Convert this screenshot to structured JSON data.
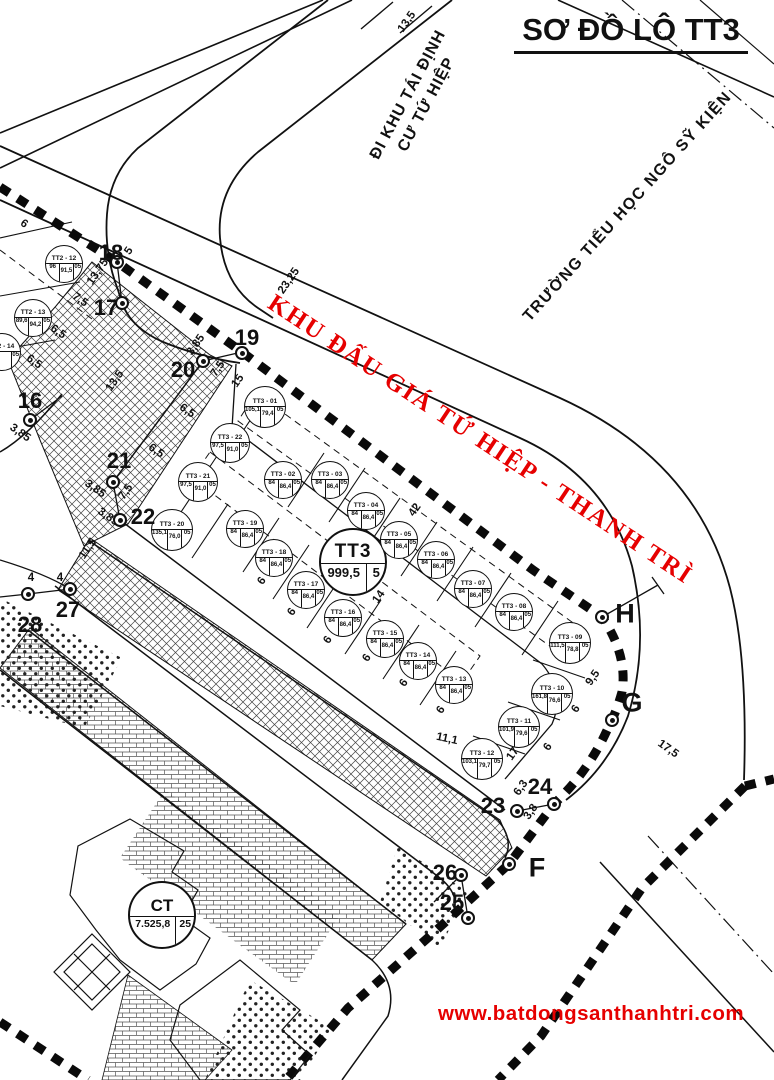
{
  "title": "SƠ ĐỒ LÔ TT3",
  "website": "www.batdongsanthanhtri.com",
  "banner": "KHU ĐẤU GIÁ TỨ HIỆP - THANH TRÌ",
  "streets": {
    "tai_dinh_line1": "ĐI KHU TÁI ĐỊNH",
    "tai_dinh_line2": "CƯ TỨ HIỆP",
    "school": "TRƯỜNG TIỂU HỌC NGÔ SỸ KIỆN"
  },
  "colors": {
    "accent_red": "#e60000",
    "ink": "#111111"
  },
  "big": {
    "tt3": {
      "code": "TT3",
      "v1": "999,5",
      "v2": "5"
    },
    "ct": {
      "code": "CT",
      "v1": "7.525,8",
      "v2": "25"
    }
  },
  "plots": [
    {
      "code": "TT2 - 12",
      "x": 64,
      "y": 264,
      "v": [
        "96",
        "91,5",
        "05"
      ]
    },
    {
      "code": "TT2 - 13",
      "x": 33,
      "y": 318,
      "v": [
        "89,6",
        "94,2",
        "05"
      ]
    },
    {
      "code": "TT2 - 14",
      "x": 2,
      "y": 352,
      "v": [
        "2",
        "",
        "05"
      ]
    },
    {
      "code": "TT3 - 01",
      "x": 265,
      "y": 407,
      "r": 21,
      "v": [
        "105,1",
        "79,4",
        "05"
      ]
    },
    {
      "code": "TT3 - 02",
      "x": 283,
      "y": 480,
      "v": [
        "84",
        "86,4",
        "05"
      ]
    },
    {
      "code": "TT3 - 03",
      "x": 330,
      "y": 480,
      "v": [
        "84",
        "86,4",
        "05"
      ]
    },
    {
      "code": "TT3 - 04",
      "x": 366,
      "y": 511,
      "v": [
        "84",
        "86,4",
        "05"
      ]
    },
    {
      "code": "TT3 - 05",
      "x": 399,
      "y": 540,
      "v": [
        "84",
        "86,4",
        "05"
      ]
    },
    {
      "code": "TT3 - 06",
      "x": 436,
      "y": 560,
      "v": [
        "84",
        "86,4",
        "05"
      ]
    },
    {
      "code": "TT3 - 07",
      "x": 473,
      "y": 589,
      "v": [
        "84",
        "86,4",
        "05"
      ]
    },
    {
      "code": "TT3 - 08",
      "x": 514,
      "y": 612,
      "v": [
        "84",
        "86,4",
        "05"
      ]
    },
    {
      "code": "TT3 - 09",
      "x": 570,
      "y": 643,
      "r": 21,
      "v": [
        "111,5",
        "78,8",
        "05"
      ]
    },
    {
      "code": "TT3 - 10",
      "x": 552,
      "y": 694,
      "r": 21,
      "v": [
        "161,8",
        "76,6",
        "05"
      ]
    },
    {
      "code": "TT3 - 11",
      "x": 519,
      "y": 727,
      "r": 21,
      "v": [
        "101,9",
        "79,6",
        "05"
      ]
    },
    {
      "code": "TT3 - 12",
      "x": 482,
      "y": 759,
      "r": 21,
      "v": [
        "103,1",
        "79,7",
        "05"
      ]
    },
    {
      "code": "TT3 - 13",
      "x": 454,
      "y": 685,
      "v": [
        "84",
        "86,4",
        "05"
      ]
    },
    {
      "code": "TT3 - 14",
      "x": 418,
      "y": 661,
      "v": [
        "84",
        "86,4",
        "05"
      ]
    },
    {
      "code": "TT3 - 15",
      "x": 385,
      "y": 639,
      "v": [
        "84",
        "86,4",
        "05"
      ]
    },
    {
      "code": "TT3 - 16",
      "x": 343,
      "y": 618,
      "v": [
        "84",
        "86,4",
        "05"
      ]
    },
    {
      "code": "TT3 - 17",
      "x": 306,
      "y": 590,
      "v": [
        "84",
        "86,4",
        "05"
      ]
    },
    {
      "code": "TT3 - 18",
      "x": 274,
      "y": 558,
      "v": [
        "84",
        "86,4",
        "05"
      ]
    },
    {
      "code": "TT3 - 19",
      "x": 245,
      "y": 529,
      "v": [
        "84",
        "86,4",
        "05"
      ]
    },
    {
      "code": "TT3 - 20",
      "x": 172,
      "y": 530,
      "r": 21,
      "v": [
        "135,1",
        "76,0",
        "05"
      ]
    },
    {
      "code": "TT3 - 21",
      "x": 198,
      "y": 482,
      "r": 20,
      "v": [
        "97,5",
        "91,0",
        "05"
      ]
    },
    {
      "code": "TT3 - 22",
      "x": 230,
      "y": 443,
      "r": 20,
      "v": [
        "97,5",
        "91,0",
        "05"
      ]
    }
  ],
  "nodes": [
    {
      "label": "16",
      "mx": 30,
      "my": 420,
      "lx": 30,
      "ly": 401
    },
    {
      "label": "17",
      "mx": 122,
      "my": 303,
      "lx": 106,
      "ly": 308
    },
    {
      "label": "18",
      "mx": 117,
      "my": 262,
      "lx": 111,
      "ly": 253
    },
    {
      "label": "19",
      "mx": 242,
      "my": 353,
      "lx": 247,
      "ly": 338
    },
    {
      "label": "20",
      "mx": 203,
      "my": 361,
      "lx": 183,
      "ly": 370
    },
    {
      "label": "21",
      "mx": 113,
      "my": 482,
      "lx": 119,
      "ly": 461
    },
    {
      "label": "22",
      "mx": 120,
      "my": 520,
      "lx": 143,
      "ly": 517
    },
    {
      "label": "23",
      "mx": 517,
      "my": 811,
      "lx": 493,
      "ly": 806
    },
    {
      "label": "24",
      "mx": 554,
      "my": 804,
      "lx": 540,
      "ly": 787
    },
    {
      "label": "25",
      "mx": 468,
      "my": 918,
      "lx": 452,
      "ly": 903
    },
    {
      "label": "26",
      "mx": 461,
      "my": 875,
      "lx": 445,
      "ly": 873
    },
    {
      "label": "27",
      "mx": 70,
      "my": 589,
      "lx": 68,
      "ly": 610
    },
    {
      "label": "28",
      "mx": 28,
      "my": 594,
      "lx": 30,
      "ly": 625
    },
    {
      "label": "F",
      "mx": 509,
      "my": 864,
      "lx": 537,
      "ly": 868,
      "big": true
    },
    {
      "label": "G",
      "mx": 612,
      "my": 720,
      "lx": 632,
      "ly": 703,
      "big": true
    },
    {
      "label": "H",
      "mx": 602,
      "my": 617,
      "lx": 625,
      "ly": 614,
      "big": true
    }
  ],
  "dims": [
    {
      "t": "13,5",
      "x": 407,
      "y": 22,
      "r": -55
    },
    {
      "t": "23,25",
      "x": 289,
      "y": 281,
      "r": -55
    },
    {
      "t": "13,75",
      "x": 98,
      "y": 272,
      "r": -55
    },
    {
      "t": "7,5",
      "x": 80,
      "y": 300,
      "r": 35
    },
    {
      "t": "6,5",
      "x": 58,
      "y": 332,
      "r": 35
    },
    {
      "t": "6,5",
      "x": 34,
      "y": 362,
      "r": 35
    },
    {
      "t": "6",
      "x": 24,
      "y": 224,
      "r": 35
    },
    {
      "t": "5",
      "x": 129,
      "y": 251,
      "r": -55
    },
    {
      "t": "13,5",
      "x": 115,
      "y": 381,
      "r": -55
    },
    {
      "t": "3,85",
      "x": 20,
      "y": 433,
      "r": 35
    },
    {
      "t": "3,85",
      "x": 196,
      "y": 345,
      "r": -55
    },
    {
      "t": "7,5",
      "x": 218,
      "y": 369,
      "r": -55
    },
    {
      "t": "15",
      "x": 238,
      "y": 381,
      "r": -55
    },
    {
      "t": "6,5",
      "x": 187,
      "y": 411,
      "r": 35
    },
    {
      "t": "6,5",
      "x": 156,
      "y": 451,
      "r": 35
    },
    {
      "t": "3,85",
      "x": 95,
      "y": 489,
      "r": 35
    },
    {
      "t": "7,5",
      "x": 126,
      "y": 492,
      "r": -55
    },
    {
      "t": "3,85",
      "x": 108,
      "y": 517,
      "r": 35
    },
    {
      "t": "11,5",
      "x": 88,
      "y": 549,
      "r": -55
    },
    {
      "t": "4",
      "x": 31,
      "y": 578,
      "r": 0
    },
    {
      "t": "4",
      "x": 60,
      "y": 578,
      "r": 0
    },
    {
      "t": "42",
      "x": 415,
      "y": 510,
      "r": -55
    },
    {
      "t": "14",
      "x": 379,
      "y": 597,
      "r": -55
    },
    {
      "t": "6",
      "x": 262,
      "y": 581,
      "r": -55
    },
    {
      "t": "6",
      "x": 292,
      "y": 612,
      "r": -55
    },
    {
      "t": "6",
      "x": 328,
      "y": 640,
      "r": -55
    },
    {
      "t": "6",
      "x": 367,
      "y": 658,
      "r": -55
    },
    {
      "t": "6",
      "x": 404,
      "y": 683,
      "r": -55
    },
    {
      "t": "6",
      "x": 441,
      "y": 710,
      "r": -55
    },
    {
      "t": "6",
      "x": 576,
      "y": 709,
      "r": -55
    },
    {
      "t": "6",
      "x": 548,
      "y": 747,
      "r": -55
    },
    {
      "t": "17",
      "x": 513,
      "y": 754,
      "r": -55
    },
    {
      "t": "9,5",
      "x": 593,
      "y": 678,
      "r": -55
    },
    {
      "t": "17,5",
      "x": 668,
      "y": 749,
      "r": 35
    },
    {
      "t": "11,1",
      "x": 447,
      "y": 739,
      "r": 12
    },
    {
      "t": "6,3",
      "x": 521,
      "y": 788,
      "r": -55
    },
    {
      "t": "3,8",
      "x": 531,
      "y": 812,
      "r": -55
    }
  ]
}
